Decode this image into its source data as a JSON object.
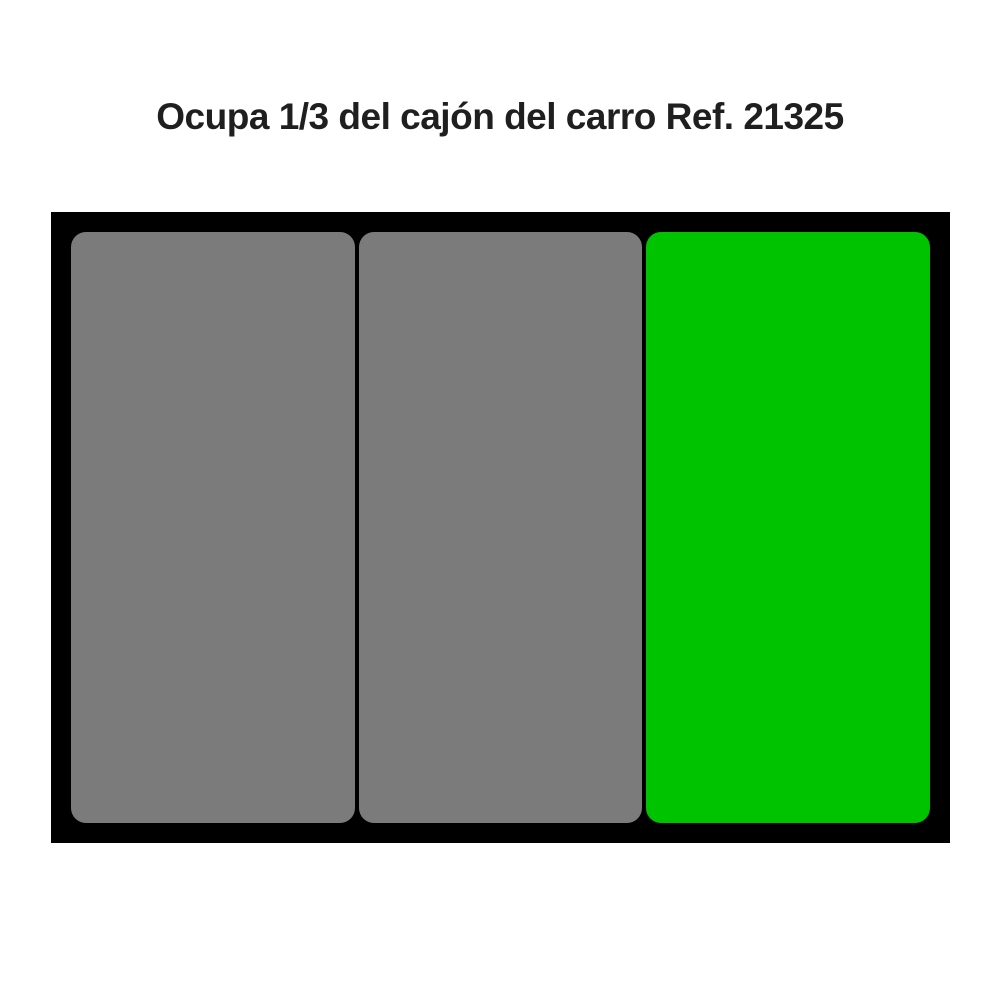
{
  "caption": {
    "text": "Ocupa 1/3 del cajón del carro Ref. 21325"
  },
  "drawer": {
    "frame_color": "#000000",
    "fraction_occupied_label": "1/3",
    "reference_number": "21325",
    "slots": [
      {
        "label": "empty-slot-1",
        "color": "#7B7B7B",
        "occupied": false
      },
      {
        "label": "empty-slot-2",
        "color": "#7B7B7B",
        "occupied": false
      },
      {
        "label": "occupied-slot",
        "color": "#00C300",
        "occupied": true
      }
    ]
  },
  "colors": {
    "background": "#FFFFFF",
    "title_text": "#1F1F1F",
    "frame": "#000000",
    "empty_slot_gray": "#7B7B7B",
    "occupied_slot_green": "#00C300"
  }
}
